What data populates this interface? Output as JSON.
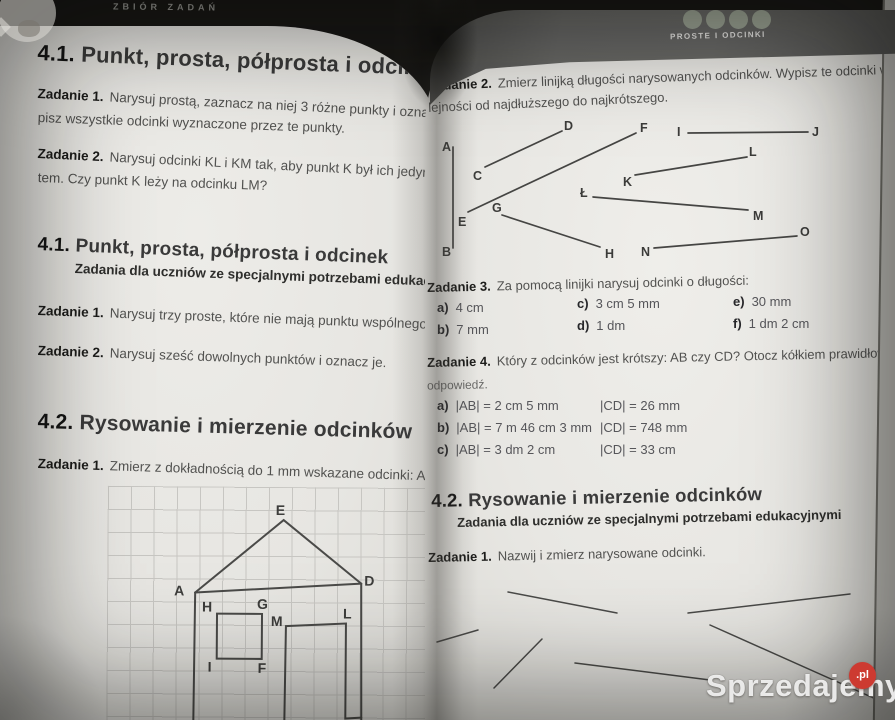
{
  "left_page": {
    "header": "ZBIÓR ZADAŃ",
    "section_41": {
      "num": "4.1.",
      "title": "Punkt, prosta, półprosta i odcinek"
    },
    "task1": {
      "label": "Zadanie 1.",
      "line1": "Narysuj prostą, zaznacz na niej 3 różne punkty i oznacz je lite",
      "line2": "pisz wszystkie odcinki wyznaczone przez te punkty."
    },
    "task2": {
      "label": "Zadanie 2.",
      "line1": "Narysuj odcinki KL i KM tak, aby punkt K był ich jedynym wspóln",
      "line2": "tem. Czy punkt K leży na odcinku LM?"
    },
    "section_41_sen": {
      "num": "4.1.",
      "title": "Punkt, prosta, półprosta i odcinek",
      "subtitle": "Zadania dla uczniów ze specjalnymi potrzebami edukacyjnymi"
    },
    "task1_sen": {
      "label": "Zadanie 1.",
      "text": "Narysuj trzy proste, które nie mają punktu wspólnego."
    },
    "task2_sen": {
      "label": "Zadanie 2.",
      "text": "Narysuj sześć dowolnych punktów i oznacz je."
    },
    "section_42": {
      "num": "4.2.",
      "title": "Rysowanie i mierzenie odcinków"
    },
    "task1_42": {
      "label": "Zadanie 1.",
      "text": "Zmierz z dokładnością do 1 mm wskazane odcinki: AB, DE, HG, IL"
    },
    "figure": {
      "labels": [
        "E",
        "A",
        "D",
        "H",
        "G",
        "M",
        "L",
        "I",
        "F"
      ]
    }
  },
  "right_page": {
    "header": "PROSTE I ODCINKI",
    "task2": {
      "label": "Zadanie 2.",
      "line1": "Zmierz linijką długości narysowanych odcinków. Wypisz te odcinki w ko-",
      "line2": "lejności od najdłuższego do najkrótszego."
    },
    "diagram": {
      "labels": [
        "A",
        "B",
        "C",
        "D",
        "E",
        "F",
        "G",
        "H",
        "I",
        "J",
        "K",
        "L",
        "Ł",
        "M",
        "N",
        "O"
      ]
    },
    "task3": {
      "label": "Zadanie 3.",
      "intro": "Za pomocą linijki narysuj odcinki o długości:",
      "items": [
        {
          "key": "a)",
          "value": "4 cm"
        },
        {
          "key": "b)",
          "value": "7 mm"
        },
        {
          "key": "c)",
          "value": "3 cm 5 mm"
        },
        {
          "key": "d)",
          "value": "1 dm"
        },
        {
          "key": "e)",
          "value": "30 mm"
        },
        {
          "key": "f)",
          "value": "1 dm 2 cm"
        }
      ]
    },
    "task4": {
      "label": "Zadanie 4.",
      "line1": "Który z odcinków jest krótszy: AB czy CD? Otocz kółkiem prawidłową",
      "line2": "odpowiedź.",
      "rows": [
        {
          "key": "a)",
          "ab": "|AB| = 2 cm 5 mm",
          "cd": "|CD| = 26 mm"
        },
        {
          "key": "b)",
          "ab": "|AB| = 7 m 46 cm 3 mm",
          "cd": "|CD| = 748 mm"
        },
        {
          "key": "c)",
          "ab": "|AB| = 3 dm 2 cm",
          "cd": "|CD| = 33 cm"
        }
      ]
    },
    "section_42": {
      "num": "4.2.",
      "title": "Rysowanie i mierzenie odcinków",
      "subtitle": "Zadania dla uczniów ze specjalnymi potrzebami edukacyjnymi"
    },
    "task1": {
      "label": "Zadanie 1.",
      "text": "Nazwij i zmierz narysowane odcinki."
    }
  },
  "watermark": {
    "text": "Sprzedajemy",
    "suffix": ".pl",
    "red": "#cd3a31"
  }
}
